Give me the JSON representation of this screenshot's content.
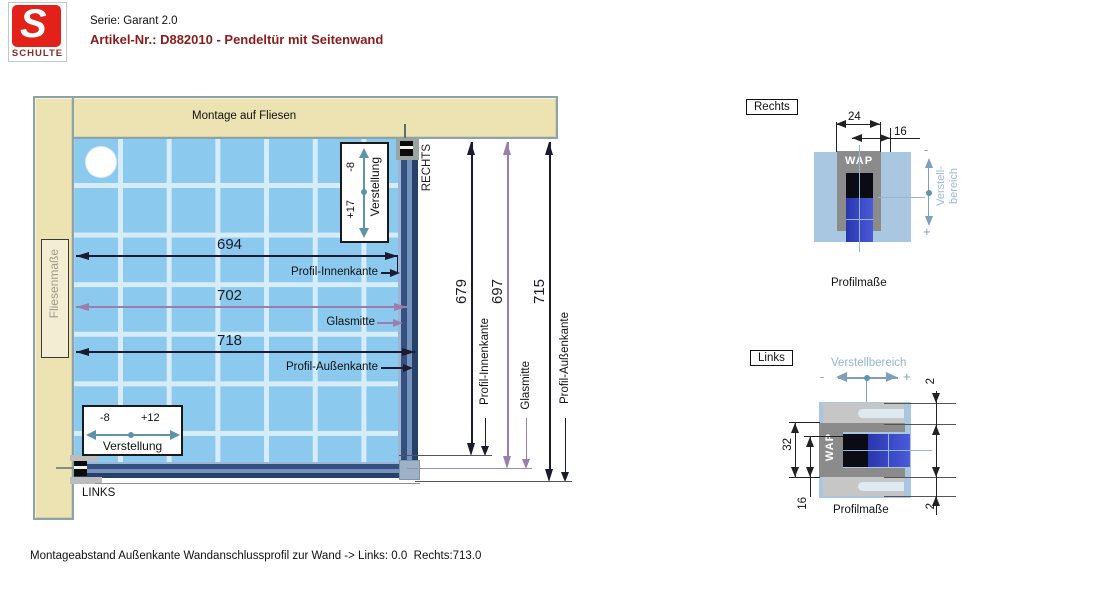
{
  "header": {
    "series": "Serie: Garant 2.0",
    "article": "Artikel-Nr.: D882010 - Pendeltür mit Seitenwand",
    "logo": {
      "letter": "S",
      "brand": "SCHULTE"
    }
  },
  "main": {
    "top_wall_label": "Montage auf Fliesen",
    "left_wall_label": "Fliesenmaße",
    "side_right_label": "RECHTS",
    "side_left_label": "LINKS",
    "width_dims": {
      "inner": {
        "value": "694",
        "label": "Profil-Innenkante"
      },
      "glass": {
        "value": "702",
        "label": "Glasmitte"
      },
      "outer": {
        "value": "718",
        "label": "Profil-Außenkante"
      }
    },
    "height_dims": {
      "inner": {
        "value": "679",
        "label": "Profil-Innenkante"
      },
      "glass": {
        "value": "697",
        "label": "Glasmitte"
      },
      "outer": {
        "value": "715",
        "label": "Profil-Außenkante"
      }
    },
    "adjust_right_profile": {
      "minus": "-8",
      "plus": "+17",
      "label": "Verstellung"
    },
    "adjust_bottom_profile": {
      "minus": "-8",
      "plus": "+12",
      "label": "Verstellung"
    }
  },
  "detail_rechts": {
    "title": "Rechts",
    "dim_profile_width": "24",
    "dim_channel_width": "16",
    "profile_label": "WAP",
    "range_label": "Verstell-bereich",
    "minus": "-",
    "plus": "+",
    "caption": "Profilmaße"
  },
  "detail_links": {
    "title": "Links",
    "range_label": "Verstellbereich",
    "minus": "-",
    "plus": "+",
    "dim_profile_height": "32",
    "dim_channel_height": "16",
    "dim_gap_top": "2",
    "dim_gap_bottom": "2",
    "profile_label": "WAP",
    "caption": "Profilmaße"
  },
  "footer": {
    "note": "Montageabstand Außenkante Wandanschlussprofil zur Wand -> Links: 0.0  Rechts:713.0"
  },
  "colors": {
    "wall_beige": "#ece2b2",
    "wall_border": "#8ba4ac",
    "tile_blue": "#8cc9ee",
    "grout": "#d6edf9",
    "profile_dark_blue": "#35507e",
    "dim_black": "#1a1a30",
    "dim_purple": "#9a7fae",
    "adjust_teal": "#5f93a8",
    "detail_bg_blue": "#a9c7e1",
    "detail_gray": "#8b8b8b",
    "glass_blue": "#3643c2",
    "range_text_blue": "#95b5cf",
    "logo_red": "#e32119",
    "article_red": "#8b1c1c"
  }
}
